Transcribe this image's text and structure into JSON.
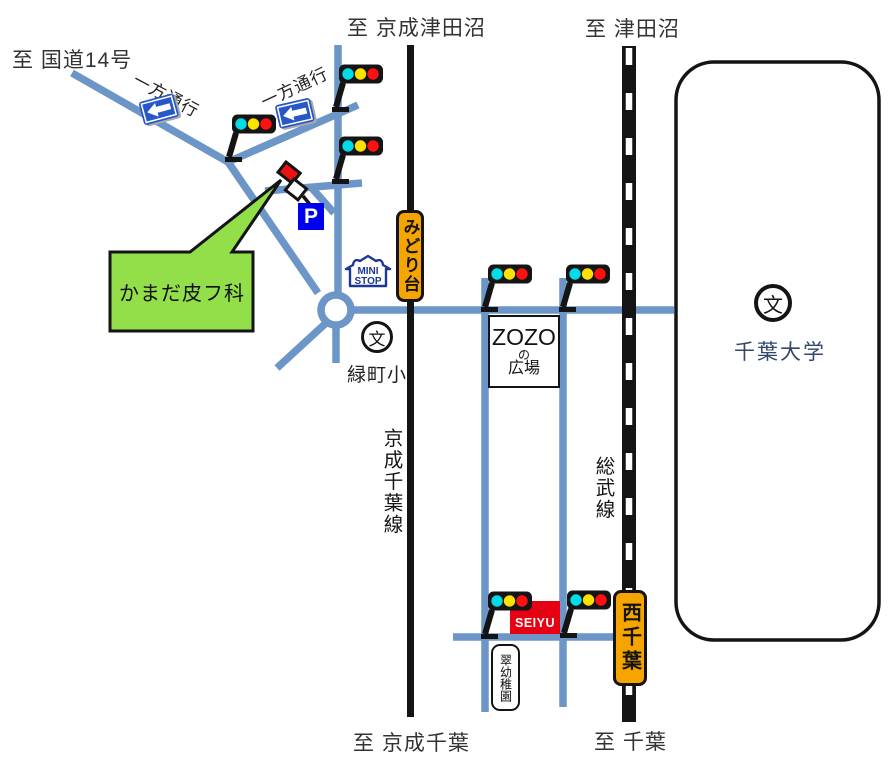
{
  "destinations": {
    "top_left": "至 国道14号",
    "top_center": "至 京成津田沼",
    "top_right": "至 津田沼",
    "bottom_center": "至 京成千葉",
    "bottom_right": "至 千葉"
  },
  "clinic": {
    "name": "かまだ皮フ科",
    "parking": "P"
  },
  "stations": {
    "midoridai": "みどり台",
    "nishichiba": "西千葉"
  },
  "railways": {
    "keisei": "京成千葉線",
    "sobu": "総武線"
  },
  "places": {
    "ministop_line1": "MINI",
    "ministop_line2": "STOP",
    "zozo_line1": "ZOZO",
    "zozo_line2": "の",
    "zozo_line3": "広場",
    "seiyu": "SEIYU",
    "midoricho_school": "緑町小",
    "kindergarten": "翠幼稚園",
    "chiba_univ": "千葉大学",
    "school_symbol": "文"
  },
  "one_way_label": "一方通行",
  "colors": {
    "road": "#6D96C8",
    "rail": "#141414",
    "station_orange": "#F5A400",
    "callout_green": "#92DF4A",
    "parking_blue": "#0000EE",
    "seiyu_red": "#E60012",
    "sign_blue": "#2857C8",
    "ministop_navy": "#1D3893",
    "light_cyan": "#00DDE6",
    "light_yellow": "#FFE100",
    "light_red": "#FF1010"
  },
  "traffic_lights": [
    {
      "x": 338,
      "y": 110
    },
    {
      "x": 338,
      "y": 182
    },
    {
      "x": 231,
      "y": 160
    },
    {
      "x": 487,
      "y": 310
    },
    {
      "x": 565,
      "y": 310
    },
    {
      "x": 487,
      "y": 637
    },
    {
      "x": 566,
      "y": 636
    }
  ],
  "one_way_signs": [
    {
      "x": 138,
      "y": 94,
      "rot": -15
    },
    {
      "x": 274,
      "y": 98,
      "rot": -13
    }
  ],
  "one_way_texts": [
    {
      "x": 141,
      "y": 66,
      "rot": 28
    },
    {
      "x": 256,
      "y": 90,
      "rot": -25
    }
  ]
}
